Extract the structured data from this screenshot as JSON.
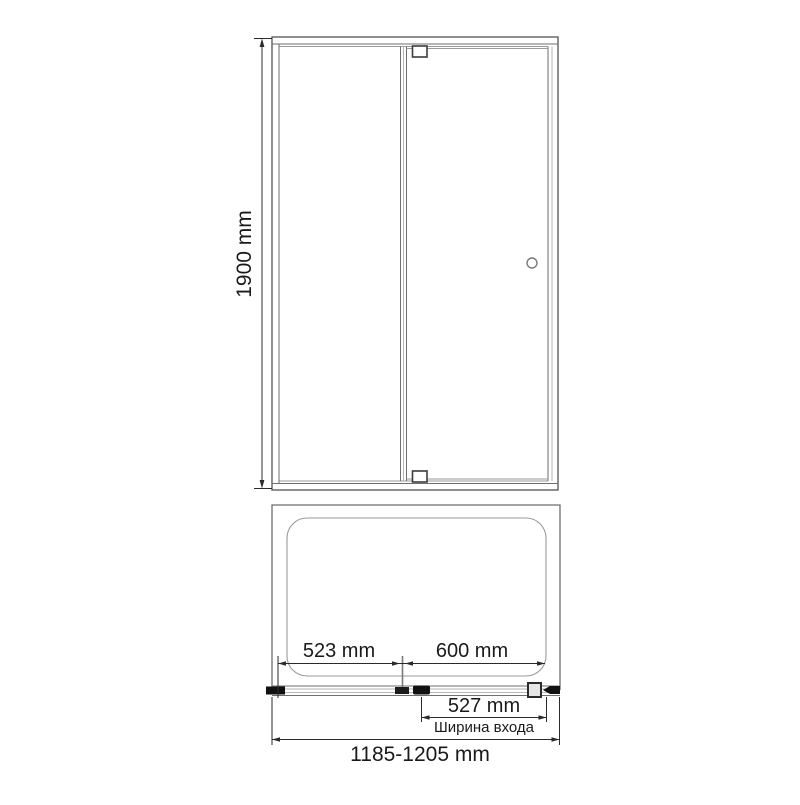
{
  "front_view": {
    "height": "1900 mm"
  },
  "plan_view": {
    "fixed_panel_width": "523 mm",
    "door_panel_width": "600 mm",
    "entrance_width": "527 mm",
    "entrance_caption": "Ширина входа",
    "total_width": "1185-1205 mm"
  },
  "colors": {
    "frame_line": "#6e6e6e",
    "glass_line": "#9a9a9a",
    "dimension": "#1a1a1a",
    "hardware_fill": "#111111",
    "background": "#ffffff"
  }
}
